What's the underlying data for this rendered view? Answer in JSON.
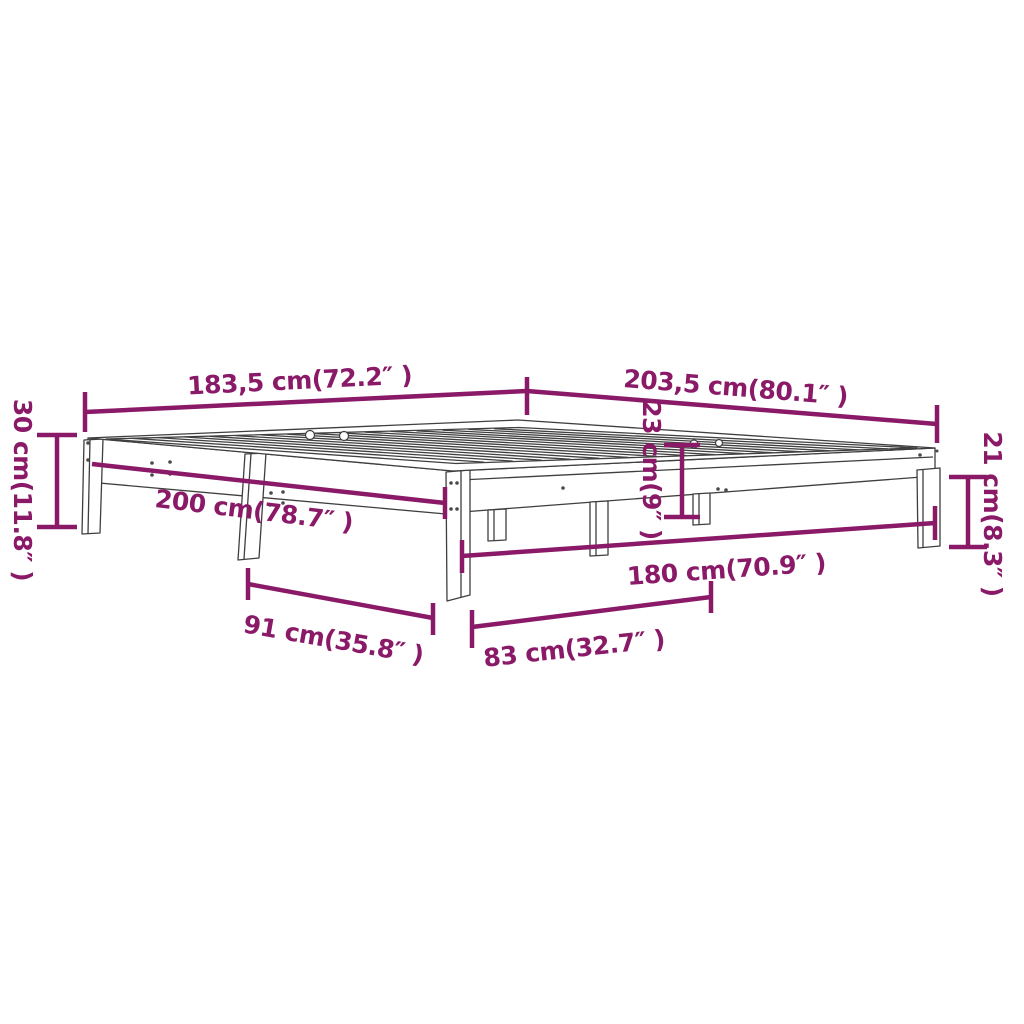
{
  "page": {
    "background_color": "#FFFFFF"
  },
  "diagram": {
    "subject": "bed-frame-isometric-line-drawing",
    "dimension_color": "#8A1A68",
    "drawing_line_color": "#3F3F3F",
    "dimensions": {
      "overall_width": "183,5 cm(72.2″ )",
      "overall_length": "203,5 cm(80.1″ )",
      "total_height": "30 cm(11.8″ )",
      "side_length": "200 cm(78.7″ )",
      "frame_depth": "23 cm(9″ )",
      "under_clearance": "21 cm(8.3″ )",
      "inner_width": "180 cm(70.9″ )",
      "leg_spacing_side": "91 cm(35.8″ )",
      "leg_spacing_front": "83 cm(32.7″ )"
    }
  }
}
